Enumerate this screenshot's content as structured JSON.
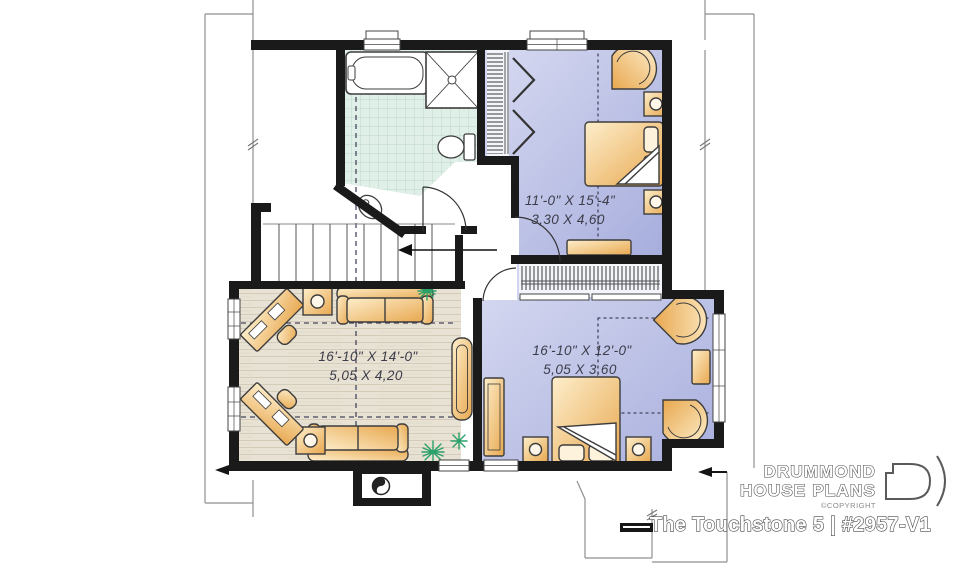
{
  "plan": {
    "rooms": {
      "bedroom_top": {
        "imperial": "11'-0\" X 15'-4\"",
        "metric": "3,30 X 4,60"
      },
      "living": {
        "imperial": "16'-10\" X 14'-0\"",
        "metric": "5,05 X 4,20"
      },
      "bedroom_bottom": {
        "imperial": "16'-10\" X 12'-0\"",
        "metric": "5,05 X 3,60"
      }
    },
    "icons": [
      "bathtub-icon",
      "shower-icon",
      "toilet-icon",
      "sink-icon",
      "bed-icon",
      "nightstand-icon",
      "sofa-icon",
      "side-table-icon",
      "desk-icon",
      "armchair-icon",
      "plant-icon",
      "fireplace-icon",
      "stair-arrow-icon",
      "window",
      "door-arc",
      "closet-rod"
    ]
  },
  "branding": {
    "brand_line1": "DRUMMOND",
    "brand_line2": "HOUSE PLANS",
    "copyright": "©COPYRIGHT",
    "plan_title": "The Touchstone 5 | #2957-V1"
  },
  "colors": {
    "wall": "#1a1a1a",
    "bedroom_floor": "#b3b9e0",
    "bathroom_tile": "#dfeee6",
    "living_floor": "#e7e1d3",
    "furniture": "#f0c585",
    "plant_green": "#2aa06a"
  }
}
